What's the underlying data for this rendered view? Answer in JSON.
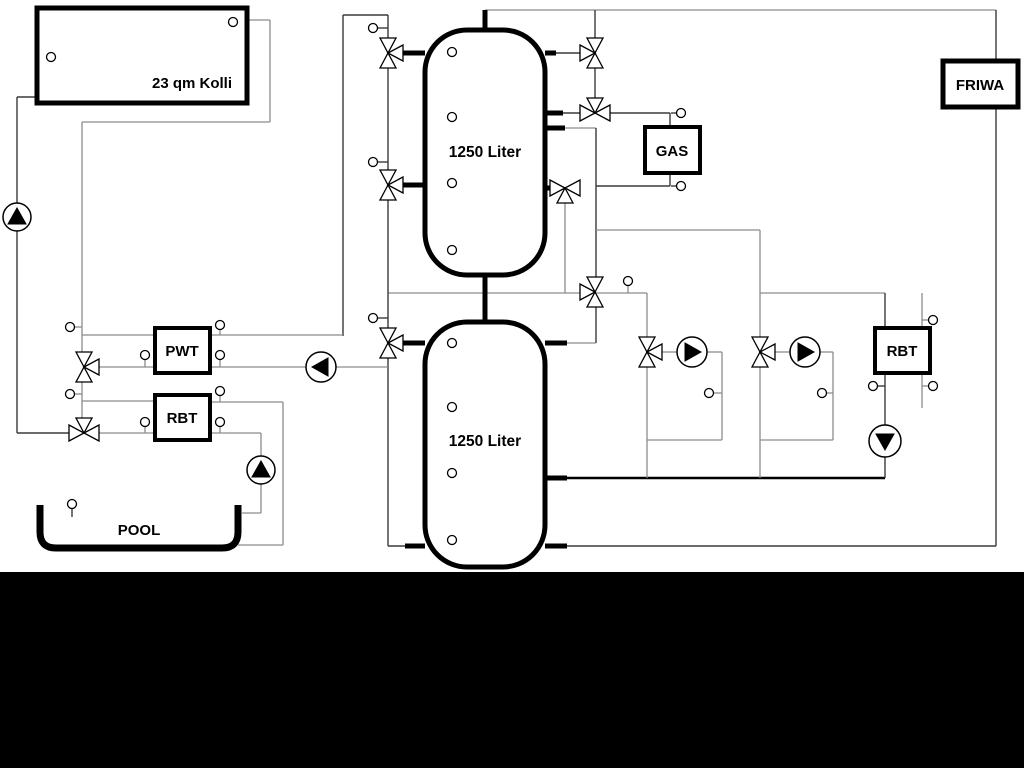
{
  "diagram": {
    "labels": {
      "collector": "23 qm Kolli",
      "tank_top": "1250 Liter",
      "tank_bottom": "1250 Liter",
      "gas": "GAS",
      "friwa": "FRIWA",
      "pwt": "PWT",
      "rbt_left": "RBT",
      "rbt_right": "RBT",
      "pool": "POOL"
    },
    "colors": {
      "pipe_gray": "#8c8c8c",
      "pipe_dark": "#3a3a3a",
      "pipe_black": "#000000",
      "outline": "#000000",
      "component_fill": "#ffffff",
      "bottom_mask": "#000000"
    },
    "equipment": {
      "tanks": [
        "1250 Liter",
        "1250 Liter"
      ],
      "heat_sources": [
        "23 qm Kolli",
        "GAS"
      ],
      "heat_exchangers": [
        "PWT",
        "RBT",
        "RBT"
      ],
      "consumers": [
        "FRIWA",
        "POOL"
      ],
      "pump_count": 6,
      "three_way_valve_count": 11,
      "sensor_count": 30
    }
  }
}
